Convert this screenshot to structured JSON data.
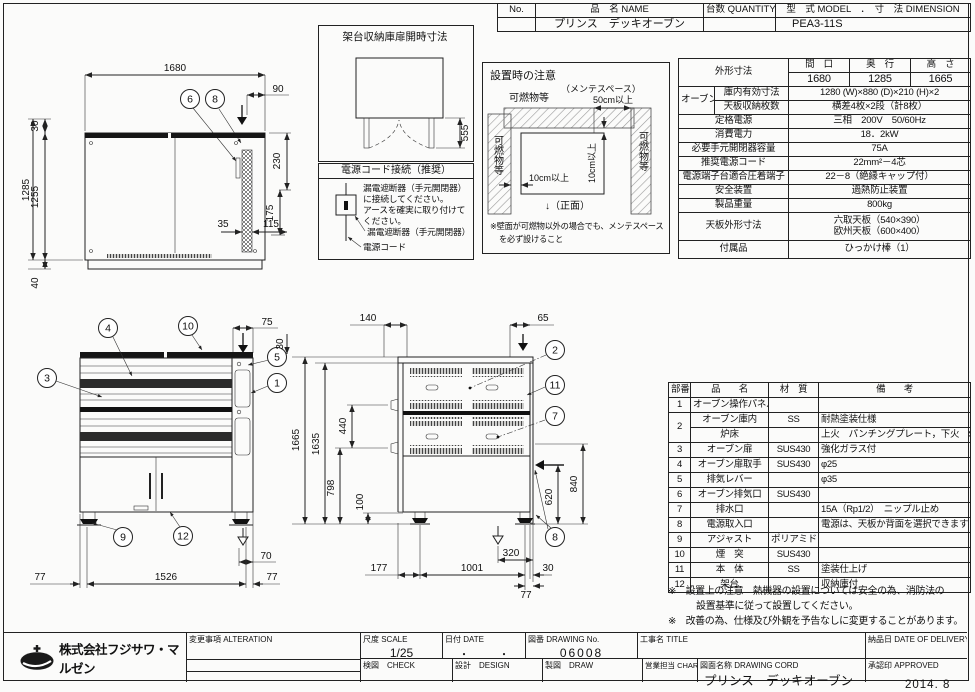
{
  "sheet": {
    "date_stamp": "2014. 8"
  },
  "company": {
    "name": "株式会社フジサワ・マルゼン"
  },
  "header_table": {
    "c_no": "No.",
    "c_name": "品　名 NAME",
    "c_qty": "台数 QUANTITY",
    "c_model": "型　式 MODEL　．　寸　法 DIMENSION",
    "v_name": "プリンス　デッキオーブン",
    "v_model": "PEA3-11S"
  },
  "spec": {
    "outer_label": "外形寸法",
    "w_label": "間　口",
    "d_label": "奥　行",
    "h_label": "高　さ",
    "w": "1680",
    "d": "1285",
    "h": "1665",
    "oven_label": "オーブン",
    "inner_label": "庫内有効寸法",
    "inner": "1280 (W)×880 (D)×210 (H)×2",
    "trays_label": "天板収納枚数",
    "trays": "横差4枚×2段（計8枚）",
    "power_label": "定格電源",
    "power": "三相　200V　50/60Hz",
    "consumption_label": "消費電力",
    "consumption": "18．2kW",
    "breaker_label": "必要手元開閉器容量",
    "breaker": "75A",
    "cord_label": "推奨電源コード",
    "cord": "22mm²－4芯",
    "terminal_label": "電源端子台適合圧着端子",
    "terminal": "22－8（絶縁キャップ付）",
    "safety_label": "安全装置",
    "safety": "過熱防止装置",
    "weight_label": "製品重量",
    "weight": "800kg",
    "tray_dim_label": "天板外形寸法",
    "tray_dim1": "六取天板（540×390）",
    "tray_dim2": "欧州天板（600×400）",
    "accessory_label": "付属品",
    "accessory": "ひっかけ棒（1）"
  },
  "parts": {
    "h_no": "部番",
    "h_name": "品　　名",
    "h_material": "材　質",
    "h_note": "備　　考",
    "rows": [
      {
        "no": "1",
        "name": "オーブン操作パネル",
        "mat": "",
        "note": ""
      },
      {
        "no": "2",
        "name": "オーブン庫内",
        "mat": "SS",
        "note": "耐熱塗装仕様"
      },
      {
        "no": "",
        "name": "炉床",
        "mat": "",
        "note": "上火　パンチングプレート，下火　SS"
      },
      {
        "no": "3",
        "name": "オーブン扉",
        "mat": "SUS430",
        "note": "強化ガラス付"
      },
      {
        "no": "4",
        "name": "オーブン扉取手",
        "mat": "SUS430",
        "note": "φ25"
      },
      {
        "no": "5",
        "name": "排気レバー",
        "mat": "",
        "note": "φ35"
      },
      {
        "no": "6",
        "name": "オーブン排気口",
        "mat": "SUS430",
        "note": ""
      },
      {
        "no": "7",
        "name": "排水口",
        "mat": "",
        "note": "15A（Rp1/2）　ニップル止め"
      },
      {
        "no": "8",
        "name": "電源取入口",
        "mat": "",
        "note": "電源は、天板か背面を選択できます"
      },
      {
        "no": "9",
        "name": "アジャスト",
        "mat": "ポリアミド",
        "note": ""
      },
      {
        "no": "10",
        "name": "煙　突",
        "mat": "SUS430",
        "note": ""
      },
      {
        "no": "11",
        "name": "本　体",
        "mat": "SS",
        "note": "塗装仕上げ"
      },
      {
        "no": "12",
        "name": "架台",
        "mat": "",
        "note": "収納庫付"
      }
    ]
  },
  "notes": {
    "l1": "※　設置上の注意　熱機器の設置については安全の為、消防法の",
    "l2": "設置基準に従って設置してください。",
    "l3": "※　改善の為、仕様及び外観を予告なしに変更することがあります。"
  },
  "rack_box": {
    "title": "架台収納庫扉開時寸法",
    "dim": "555"
  },
  "power_box": {
    "title": "電源コード接続（推奨）",
    "t1": "漏電遮断器（手元開閉器）",
    "t2": "に接続してください。",
    "t3": "アースを確実に取り付けて",
    "t4": "ください。",
    "label_breaker": "漏電遮断器（手元開閉器）",
    "label_cord": "電源コード"
  },
  "install_box": {
    "title": "設置時の注意",
    "combustible_top": "可燃物等",
    "combustible_left": "可燃物等",
    "combustible_right": "可燃物等",
    "maint": "（メンテスペース）",
    "d50": "50cm以上",
    "d10v": "10cm以上",
    "d10h": "10cm以上",
    "front": "↓（正面）",
    "note1": "※壁面が可燃物以外の場合でも、メンテスペース",
    "note2": "を必ず設けること"
  },
  "plan": {
    "d1680": "1680",
    "d90": "90",
    "d30": "30",
    "d1255": "1255",
    "d1285": "1285",
    "d40": "40",
    "d230": "230",
    "d175": "175",
    "d35": "35",
    "d115": "115",
    "c6": "6",
    "c8": "8"
  },
  "front": {
    "d75": "75",
    "d70": "70",
    "d77l": "77",
    "d1526": "1526",
    "d77r": "77",
    "c1": "1",
    "c3": "3",
    "c4": "4",
    "c5": "5",
    "c9": "9",
    "c10": "10",
    "c12": "12"
  },
  "side": {
    "d140": "140",
    "d65": "65",
    "d30": "30",
    "d1665": "1665",
    "d1635": "1635",
    "d440": "440",
    "d798": "798",
    "d100": "100",
    "d840": "840",
    "d620": "620",
    "d320": "320",
    "d177": "177",
    "d1001": "1001",
    "d30b": "30",
    "d77": "77",
    "c2": "2",
    "c7": "7",
    "c8": "8",
    "c11": "11"
  },
  "title_block": {
    "alteration": "変更事項 ALTERATION",
    "scale_label": "尺度 SCALE",
    "scale": "1/25",
    "date_label": "日付 DATE",
    "date": "・　　　・",
    "dwg_label": "図番 DRAWING No.",
    "dwg_no": "06008",
    "title_label": "工事名 TITLE",
    "delivery_label": "納品日 DATE OF DELIVERY",
    "check": "検図　CHECK",
    "design": "設計　DESIGN",
    "draw": "製図　DRAW",
    "charge": "営業担当 CHARGE",
    "name_label": "図面名称 DRAWING CORD",
    "drawing_name": "プリンス　デッキオーブン",
    "approved": "承認印 APPROVED"
  }
}
